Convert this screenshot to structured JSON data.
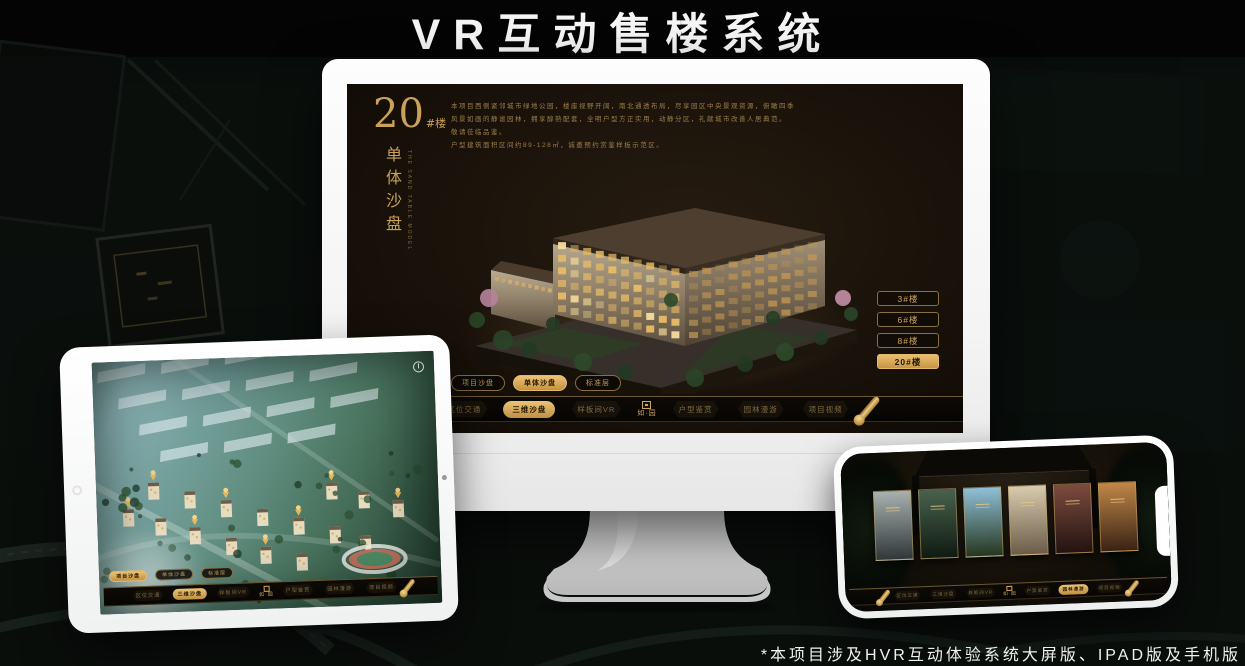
{
  "banner": {
    "title": "VR互动售楼系统"
  },
  "footnote": "*本项目涉及HVR互动体验系统大屏版、IPAD版及手机版",
  "colors": {
    "gold": "#d2a85e",
    "gold_bright": "#ecc377",
    "gold_dim": "#8a6f3f",
    "screen_bg": "#1c140b",
    "strip_bg": "#0b0805",
    "active_text": "#241703"
  },
  "brand": {
    "logo_text": "如·园"
  },
  "menu": {
    "items": [
      {
        "label": "区位交通"
      },
      {
        "label": "三维沙盘"
      },
      {
        "label": "样板间VR"
      },
      {
        "label": "户型鉴赏"
      },
      {
        "label": "园林漫游"
      },
      {
        "label": "项目视频"
      }
    ]
  },
  "monitor": {
    "block_number": "20",
    "block_unit": "#楼",
    "subtitle": "单体沙盘",
    "subtitle_en": "THE SAND TABLE MODEL",
    "description_lines": [
      "本项目西侧紧邻城市绿地公园，楼座视野开阔，南北通透布局，尽享园区中央景观资源，俯瞰四季",
      "风景如画的静谧园林，拥享醇熟配套，全明户型方正实用，动静分区，礼献城市改善人居典范。",
      "敬请莅临品鉴。",
      "户型建筑面积区间约89-128㎡，诚邀预约赏鉴样板示范区。"
    ],
    "sub_tabs": [
      {
        "label": "项目沙盘",
        "active": false
      },
      {
        "label": "单体沙盘",
        "active": true
      },
      {
        "label": "标准层",
        "active": false
      }
    ],
    "floor_buttons": [
      {
        "label": "3#楼",
        "active": false
      },
      {
        "label": "6#楼",
        "active": false
      },
      {
        "label": "8#楼",
        "active": false
      },
      {
        "label": "20#楼",
        "active": true
      }
    ],
    "menu_active": "三维沙盘"
  },
  "tablet": {
    "sub_tabs": [
      {
        "label": "项目沙盘",
        "active": true
      },
      {
        "label": "单体沙盘",
        "active": false
      },
      {
        "label": "标准层",
        "active": false
      }
    ],
    "menu_active": "三维沙盘"
  },
  "phone": {
    "menu_active": "园林漫游",
    "panels": [
      {
        "name": "misty-courtyard",
        "from": "#a9b1b0",
        "to": "#2f3739"
      },
      {
        "name": "garden-interior",
        "from": "#49624c",
        "to": "#0f1a12"
      },
      {
        "name": "sky-garden-path",
        "from": "#8fc0d8",
        "to": "#26361e"
      },
      {
        "name": "building-facade",
        "from": "#d8cbae",
        "to": "#6a5c48"
      },
      {
        "name": "gallery-red",
        "from": "#7c4c3e",
        "to": "#231310"
      },
      {
        "name": "warm-shelves",
        "from": "#c18748",
        "to": "#3a2314"
      }
    ]
  }
}
